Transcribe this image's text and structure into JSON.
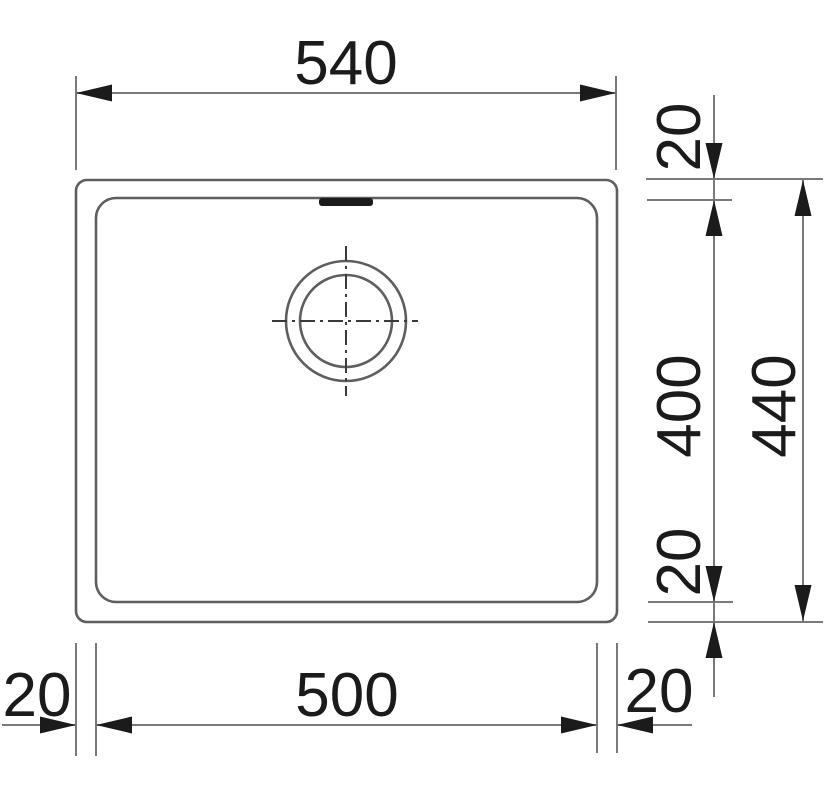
{
  "drawing": {
    "title": "Sink dimension drawing (top view)",
    "dims": {
      "overall_width": "540",
      "overall_height": "440",
      "bowl_width": "500",
      "bowl_height": "400",
      "rim_top": "20",
      "rim_bottom": "20",
      "rim_left": "20",
      "rim_right": "20"
    },
    "colors": {
      "background": "#ffffff",
      "outline": "#5e5e5e",
      "dimension_line": "#7a7a7a",
      "ink": "#1b1b1b"
    }
  }
}
